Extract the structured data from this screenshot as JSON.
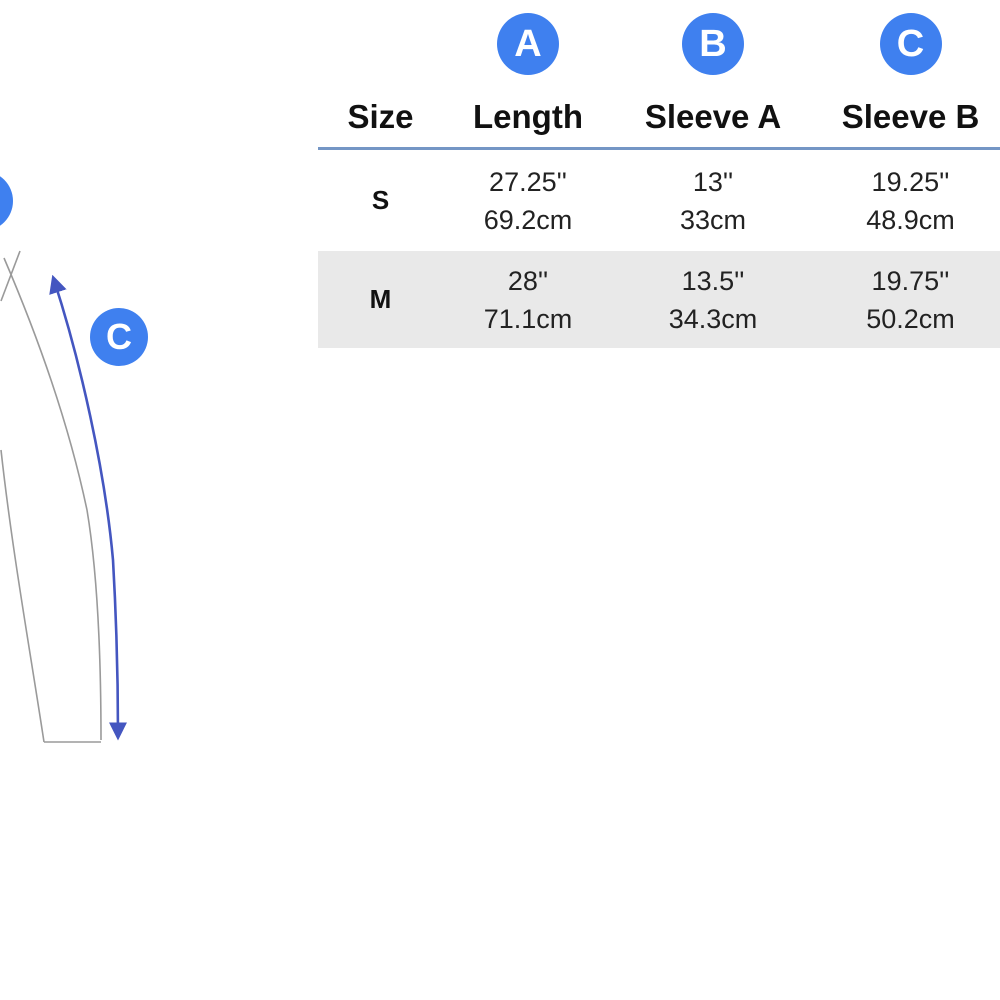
{
  "diagram": {
    "badge_label": "C",
    "description_labels": {
      "arrow": "sleeve outer length measurement",
      "partial_badge": "cropped measurement badge"
    }
  },
  "size_chart": {
    "corner_header": "Size",
    "columns": [
      {
        "badge": "A",
        "label": "Length"
      },
      {
        "badge": "B",
        "label": "Sleeve A"
      },
      {
        "badge": "C",
        "label": "Sleeve B"
      }
    ],
    "rows": [
      {
        "size": "S",
        "values": [
          {
            "inches": "27.25''",
            "cm": "69.2cm"
          },
          {
            "inches": "13''",
            "cm": "33cm"
          },
          {
            "inches": "19.25''",
            "cm": "48.9cm"
          }
        ]
      },
      {
        "size": "M",
        "values": [
          {
            "inches": "28''",
            "cm": "71.1cm"
          },
          {
            "inches": "13.5''",
            "cm": "34.3cm"
          },
          {
            "inches": "19.75''",
            "cm": "50.2cm"
          }
        ]
      }
    ]
  },
  "colors": {
    "badge_blue": "#3f80ef",
    "header_rule_blue": "#7496c5",
    "alt_row_gray": "#e9e9e9",
    "arrow_blue": "#4456c0",
    "garment_outline_gray": "#9a9a9a",
    "text_black": "#1e1e1e"
  }
}
